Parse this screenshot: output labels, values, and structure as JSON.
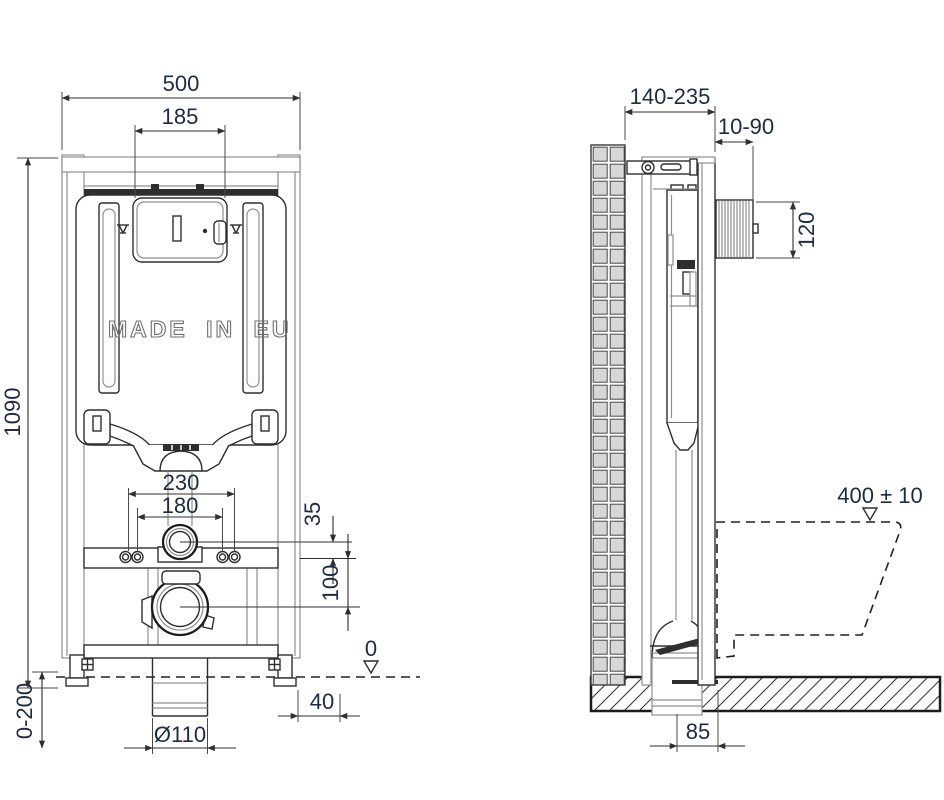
{
  "front": {
    "width": "500",
    "opening_width": "185",
    "height": "1090",
    "rod_spacing": "230",
    "flush_spacing": "180",
    "flush_offset": "35",
    "waste_offset": "100",
    "datum_zero": "0",
    "floor_adjust": "0-200",
    "edge_offset": "40",
    "waste_diameter": "Ø110",
    "made_in": "MADE IN EU"
  },
  "side": {
    "depth": "140-235",
    "finish_range": "10-90",
    "box_height": "120",
    "seat_height": "400 ± 10",
    "waste_to_wall": "85"
  },
  "colors": {
    "line_dark": "#2f2f2f",
    "line_light": "#8f8f8f",
    "dim_text": "#1f2a44",
    "wall_fill": "#d7d7d7",
    "dark_fill": "#2e2e2e"
  }
}
